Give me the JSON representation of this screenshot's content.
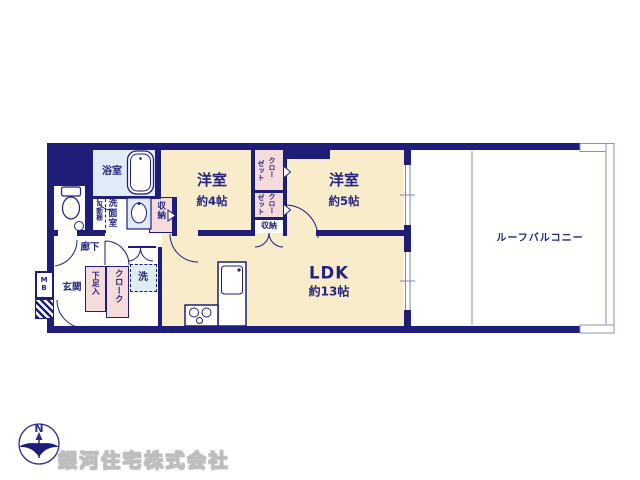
{
  "colors": {
    "wall_navy": "#1e1e78",
    "room_cream": "#f8ecca",
    "closet_pink": "#f6dbdc",
    "wet_area_blue": "#e1ebf7",
    "laundry_blue": "#ddeef2",
    "balcony_line": "#8a93c0",
    "watermark_gray": "#bdbdbd"
  },
  "rooms": {
    "bath": {
      "label": "浴室"
    },
    "washroom": {
      "label": "洗面室"
    },
    "movable_shelf": {
      "label": "可動棚"
    },
    "hall_storage": {
      "label": "収納"
    },
    "western4": {
      "label": "洋室",
      "size": "約4帖"
    },
    "closet_upper": {
      "line1": "クロー",
      "line2": "ゼット"
    },
    "closet_lower": {
      "line1": "クロー",
      "line2": "ゼット"
    },
    "closet_storage": {
      "label": "収納"
    },
    "western5": {
      "label": "洋室",
      "size": "約5帖"
    },
    "corridor": {
      "label": "廊下"
    },
    "entrance": {
      "label": "玄関"
    },
    "meter_box": {
      "label": "MB"
    },
    "shoe_box": {
      "label": "下足入"
    },
    "cloak": {
      "label": "クローク"
    },
    "laundry": {
      "label": "洗"
    },
    "ldk": {
      "label": "LDK",
      "size": "約13帖"
    },
    "roof_balcony": {
      "label": "ルーフバルコニー"
    }
  },
  "compass": {
    "north_label": "N"
  },
  "footer": {
    "company": "銀河住宅株式会社"
  }
}
